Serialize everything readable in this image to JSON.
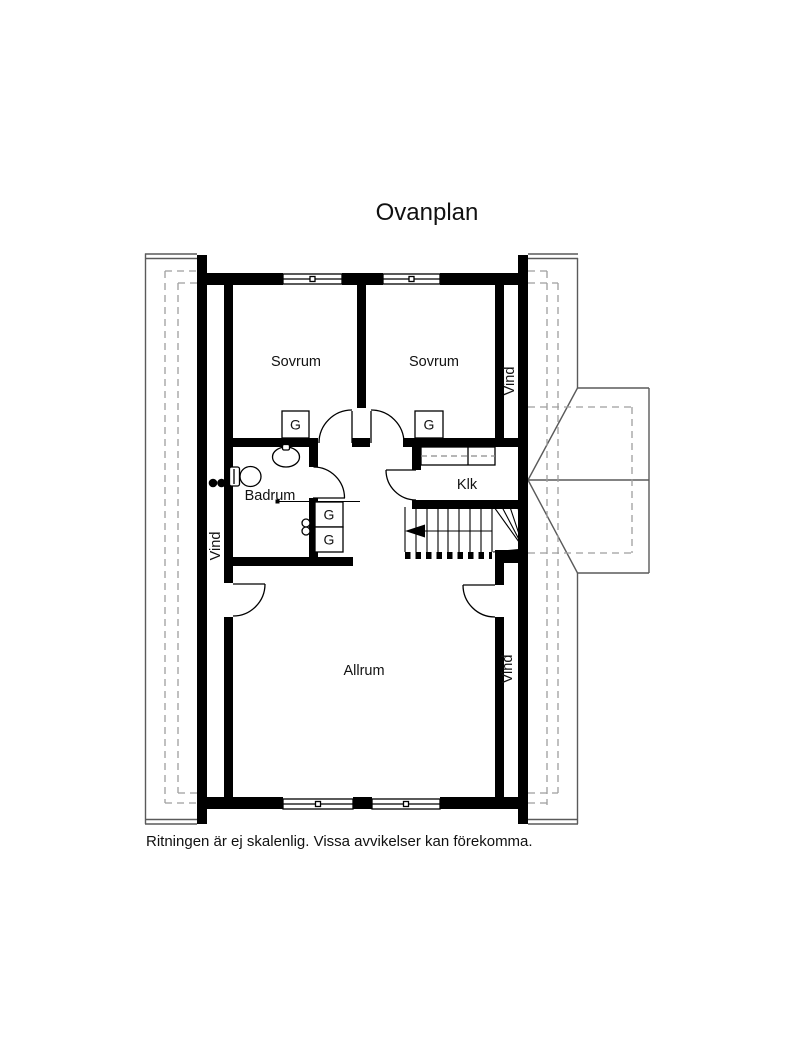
{
  "title": "Ovanplan",
  "footer_note": "Ritningen är ej skalenlig. Vissa avvikelser kan förekomma.",
  "rooms": {
    "sovrum_left": "Sovrum",
    "sovrum_right": "Sovrum",
    "badrum": "Badrum",
    "klk": "Klk",
    "allrum": "Allrum",
    "vind_left": "Vind",
    "vind_upper_right": "Vind",
    "vind_lower_right": "Vind"
  },
  "closets": {
    "label": "G"
  },
  "colors": {
    "background": "#ffffff",
    "wall": "#000000",
    "roof_line": "#5a5a5a",
    "roof_dashed": "#9e9e9e",
    "text": "#111111"
  }
}
